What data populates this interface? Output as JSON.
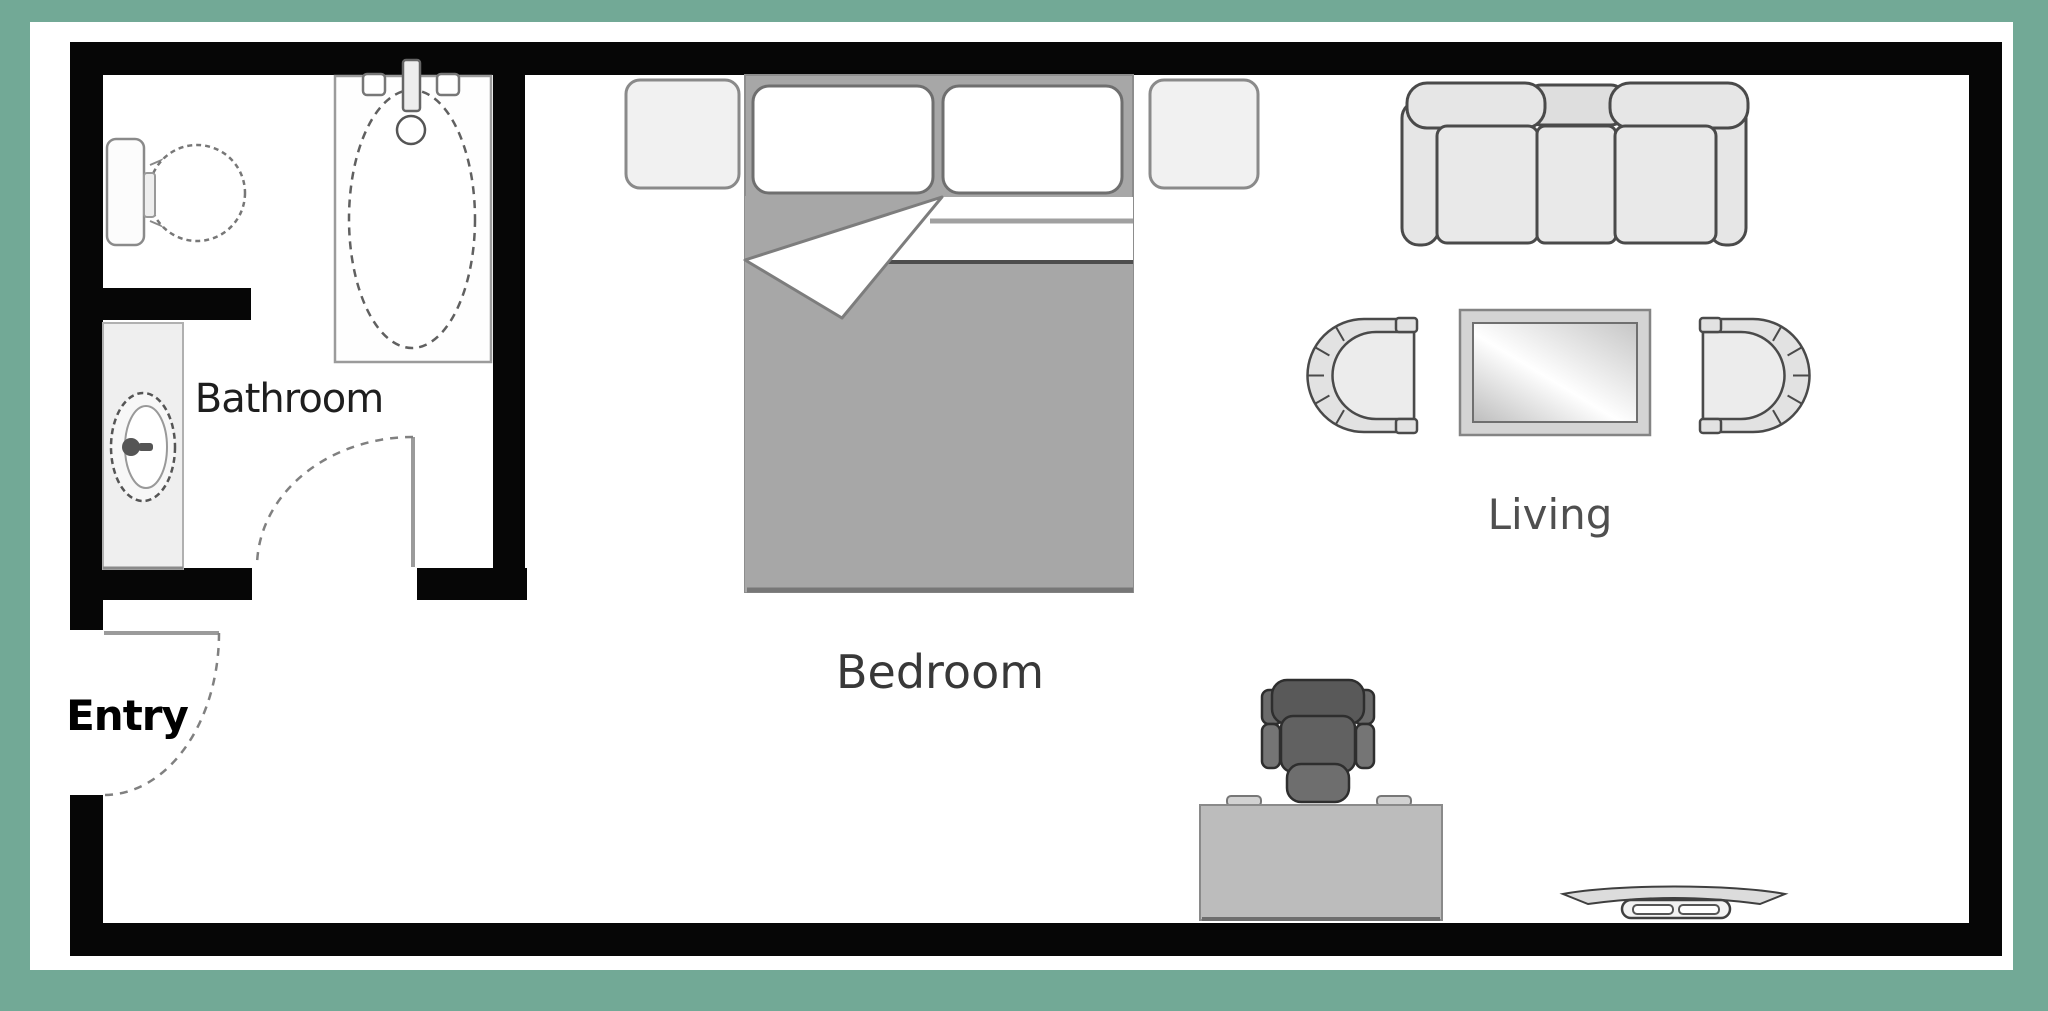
{
  "frame": {
    "background_color": "#72a996",
    "floor_color": "#ffffff",
    "wall_color": "#060606"
  },
  "labels": {
    "bathroom": "Bathroom",
    "entry": "Entry",
    "bedroom": "Bedroom",
    "living": "Living"
  },
  "palette": {
    "furniture_fill": "#e6e6e6",
    "furniture_stroke": "#4a4a4a",
    "bed_blanket_gray": "#a7a7a7",
    "pillow_white": "#ffffff",
    "nightstand_fill": "#f1f1f1",
    "desk_fill": "#bcbcbc",
    "office_chair_fill": "#5f5f5f",
    "glass_highlight": "#ffffff",
    "glass_shade": "#bdbdbd"
  },
  "fixtures": {
    "bathroom": [
      "toilet-icon",
      "bathtub-icon",
      "sink-icon",
      "bathroom-door-arc-icon"
    ],
    "entry": [
      "entry-door-arc-icon"
    ],
    "bedroom": [
      "double-bed-icon",
      "pillow-icon",
      "pillow-icon",
      "nightstand-icon",
      "nightstand-icon"
    ],
    "living": [
      "sofa-icon",
      "armchair-icon",
      "armchair-icon",
      "coffee-table-icon"
    ],
    "work_area": [
      "desk-icon",
      "office-chair-icon",
      "tv-console-icon"
    ]
  }
}
